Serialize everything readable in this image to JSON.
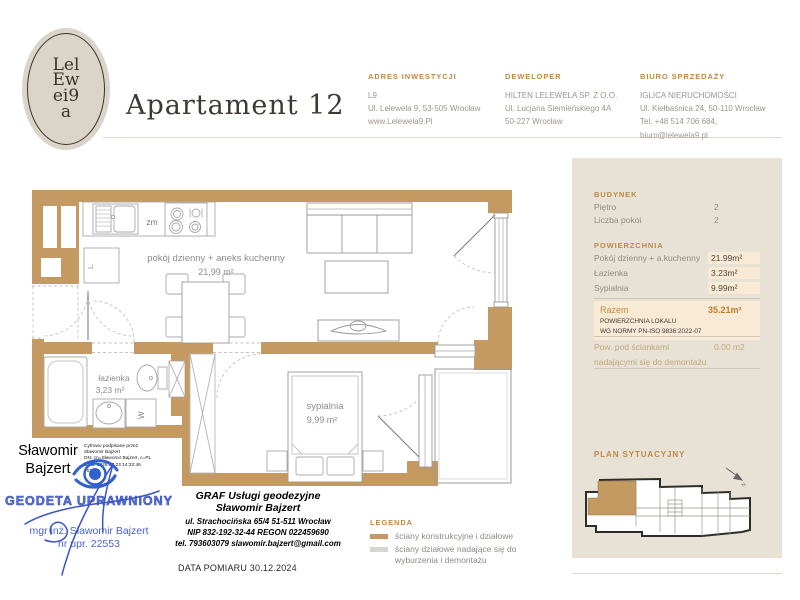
{
  "brand": {
    "logo_lines": [
      "Lel",
      "Ew",
      "ei9",
      "a"
    ]
  },
  "header": {
    "title": "Apartament 12",
    "columns": [
      {
        "heading": "ADRES INWESTYCJI",
        "lines": [
          "L9",
          "Ul. Lelewela 9, 53-505 Wrocław",
          "www.Lelewela9.Pl"
        ]
      },
      {
        "heading": "DEWELOPER",
        "lines": [
          "HILTEN LELEWELA SP. Z O.O.",
          "Ul. Lucjana Siemieńskiego 4A",
          "50-227 Wrocław"
        ]
      },
      {
        "heading": "BIURO SPRZEDAŻY",
        "lines": [
          "IGLICA NIERUCHOMOŚCI",
          "Ul. Kiełbaśnica 24, 50-110 Wrocław",
          "Tel. +48 514 706 684, biuro@lelewela9.pl"
        ]
      }
    ]
  },
  "sidebar": {
    "budynek": {
      "heading": "BUDYNEK",
      "rows": [
        {
          "label": "Piętro",
          "value": "2"
        },
        {
          "label": "Liczba pokoi",
          "value": "2"
        }
      ]
    },
    "powierzchnia": {
      "heading": "POWIERZCHNIA",
      "rows": [
        {
          "label": "Pokój dzienny + a.kuchenny",
          "value": "21.99m²"
        },
        {
          "label": "Łazienka",
          "value": "3.23m²"
        },
        {
          "label": "Sypialnia",
          "value": "9.99m²"
        }
      ]
    },
    "razem": {
      "label": "Razem",
      "value": "35.21m²",
      "note_line1": "POWIERZCHNIA LOKALU",
      "note_line2": "WG NORMY PN-ISO 9836:2022-07"
    },
    "demontaz": {
      "label_line1": "Pow. pod ściankami",
      "label_line2": "nadającymi się do demontażu",
      "value": "0.00 m2"
    },
    "plan_heading": "PLAN SYTUACYJNY"
  },
  "floor_plan": {
    "rooms": [
      {
        "name": "pokój dzienny + aneks kuchenny",
        "area": "21,99 m²"
      },
      {
        "name": "łazienka",
        "area": "3,23 m²"
      },
      {
        "name": "sypialnia",
        "area": "9,99 m²"
      }
    ],
    "fixture_labels": {
      "dishwasher": "zm",
      "washing_machine": "W",
      "fridge": "L."
    }
  },
  "signature_stamp": {
    "signer_line1": "Sławomir",
    "signer_line2": "Bajzert",
    "digital_note_lines": [
      "Cyfrowo podpisane przez",
      "Sławomir Bajzert",
      "DN: cn=Sławomir Bajzert, c=PL",
      "Data: 2025.03.23 14:32:46",
      "+01'00'"
    ],
    "stamp_title": "GEODETA UPRAWNIONY",
    "stamp_name": "mgr inż. Sławomir Bajzert",
    "stamp_number": "nr upr. 22553"
  },
  "surveyor_block": {
    "lines": [
      "GRAF Usługi geodezyjne",
      "Sławomir Bajzert",
      "ul. Strachocińska 65/4  51-511 Wrocław",
      "NIP 832-192-32-44  REGON 022459690",
      "tel. 793603079  slawomir.bajzert@gmail.com"
    ],
    "measurement_date": "DATA POMIARU 30.12.2024"
  },
  "legend": {
    "heading": "LEGENDA",
    "items": [
      {
        "label": "ściany konstrukcyjne i działowe"
      },
      {
        "label": "ściany działowe nadające się do wyburzenia i demontażu"
      }
    ]
  },
  "colors": {
    "wall": "#c49a62",
    "accent": "#bd8a45",
    "sidebar_bg": "#e8e2d6",
    "value_highlight": "#f8ead4",
    "stamp_blue": "#3c55c5",
    "removable_wall": "#d8d5cf"
  }
}
